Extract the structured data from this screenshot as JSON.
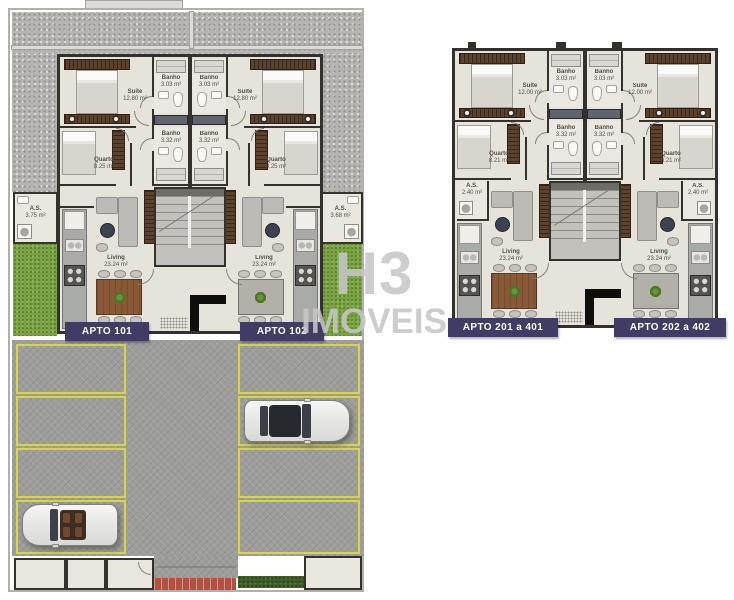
{
  "watermark": {
    "line1": "H3",
    "line2": "IMOVEIS"
  },
  "ground": {
    "unit1": {
      "label": "APTO 101",
      "rooms": {
        "suite": {
          "name": "Suíte",
          "area": "12.80 m²"
        },
        "banho1": {
          "name": "Banho",
          "area": "3.03 m²"
        },
        "banho2": {
          "name": "Banho",
          "area": "3.32 m²"
        },
        "quarto": {
          "name": "Quarto",
          "area": "8.25 m²"
        },
        "as": {
          "name": "A.S.",
          "area": "3.75 m²"
        },
        "living": {
          "name": "Living",
          "area": "23.24 m²"
        }
      }
    },
    "unit2": {
      "label": "APTO 102",
      "rooms": {
        "suite": {
          "name": "Suíte",
          "area": "12.80 m²"
        },
        "banho1": {
          "name": "Banho",
          "area": "3.03 m²"
        },
        "banho2": {
          "name": "Banho",
          "area": "3.32 m²"
        },
        "quarto": {
          "name": "Quarto",
          "area": "8.25 m²"
        },
        "as": {
          "name": "A.S.",
          "area": "3.68 m²"
        },
        "living": {
          "name": "Living",
          "area": "23.24 m²"
        }
      }
    }
  },
  "upper": {
    "unit1": {
      "label": "APTO 201 a 401",
      "rooms": {
        "suite": {
          "name": "Suíte",
          "area": "12.00 m²"
        },
        "banho1": {
          "name": "Banho",
          "area": "3.03 m²"
        },
        "banho2": {
          "name": "Banho",
          "area": "3.32 m²"
        },
        "quarto": {
          "name": "Quarto",
          "area": "8.21 m²"
        },
        "as": {
          "name": "A.S.",
          "area": "2.40 m²"
        },
        "living": {
          "name": "Living",
          "area": "23.24 m²"
        }
      }
    },
    "unit2": {
      "label": "APTO 202 a 402",
      "rooms": {
        "suite": {
          "name": "Suíte",
          "area": "12.00 m²"
        },
        "banho1": {
          "name": "Banho",
          "area": "3.03 m²"
        },
        "banho2": {
          "name": "Banho",
          "area": "3.32 m²"
        },
        "quarto": {
          "name": "Quarto",
          "area": "8.21 m²"
        },
        "as": {
          "name": "A.S.",
          "area": "2.40 m²"
        },
        "living": {
          "name": "Living",
          "area": "23.24 m²"
        }
      }
    }
  },
  "colors": {
    "label_bg": "#403C66",
    "parking_line": "#D9D63E",
    "grass": "#7AA242",
    "watermark": "#C6C6C6"
  }
}
